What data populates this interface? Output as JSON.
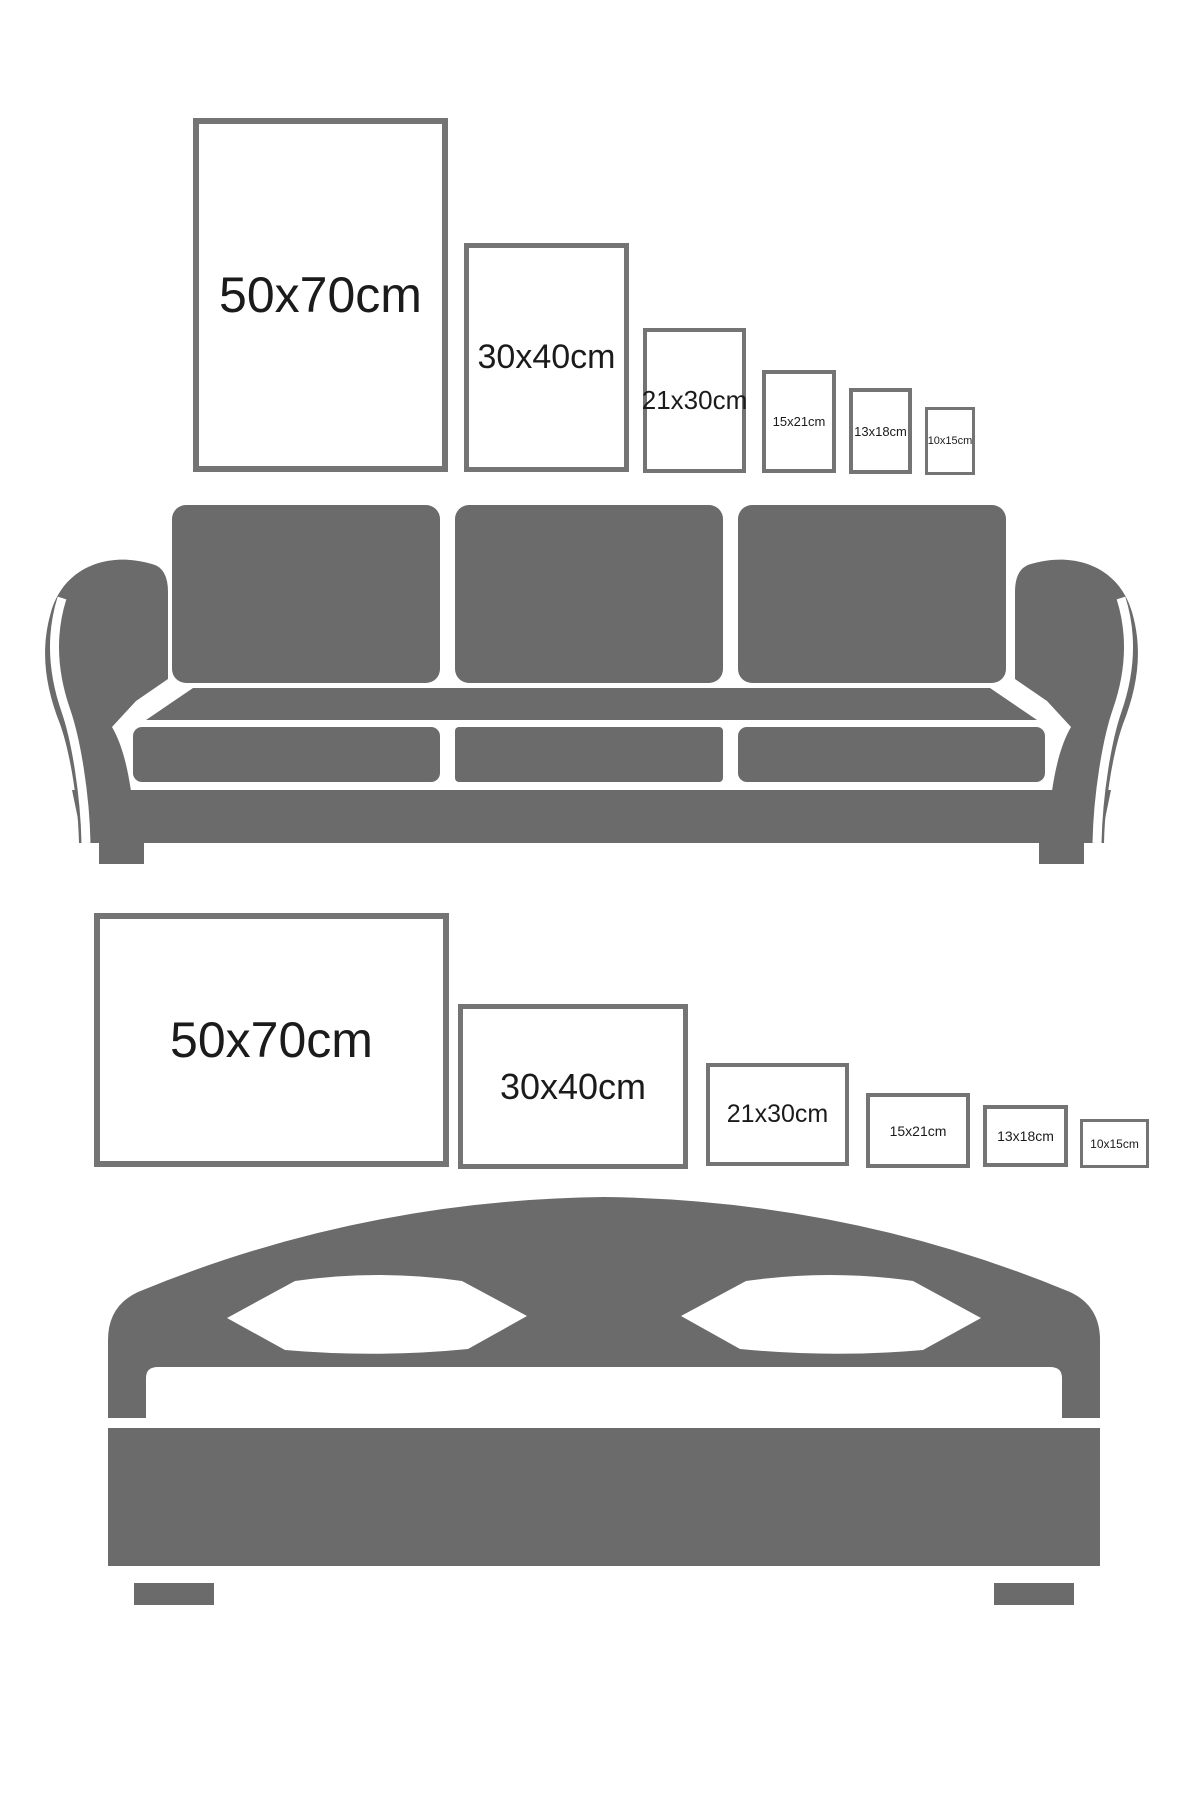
{
  "page": {
    "width": 1200,
    "height": 1800,
    "background": "#ffffff"
  },
  "colors": {
    "furniture_gray": "#6b6b6b",
    "frame_border_gray": "#747474",
    "label_color": "#1b1b1b",
    "frame_fill": "#ffffff"
  },
  "portrait_section": {
    "furniture": "sofa",
    "orientation": "portrait",
    "frames": [
      {
        "label": "50x70cm",
        "x": 193,
        "y": 118,
        "w": 255,
        "h": 354,
        "border_px": 6,
        "font_px": 50
      },
      {
        "label": "30x40cm",
        "x": 464,
        "y": 243,
        "w": 165,
        "h": 229,
        "border_px": 5,
        "font_px": 34
      },
      {
        "label": "21x30cm",
        "x": 643,
        "y": 328,
        "w": 103,
        "h": 145,
        "border_px": 4,
        "font_px": 26
      },
      {
        "label": "15x21cm",
        "x": 762,
        "y": 370,
        "w": 74,
        "h": 103,
        "border_px": 4,
        "font_px": 13
      },
      {
        "label": "13x18cm",
        "x": 849,
        "y": 388,
        "w": 63,
        "h": 86,
        "border_px": 4,
        "font_px": 13
      },
      {
        "label": "10x15cm",
        "x": 925,
        "y": 407,
        "w": 50,
        "h": 68,
        "border_px": 3,
        "font_px": 11
      }
    ]
  },
  "landscape_section": {
    "furniture": "bed",
    "orientation": "landscape",
    "frames": [
      {
        "label": "50x70cm",
        "x": 94,
        "y": 913,
        "w": 355,
        "h": 254,
        "border_px": 6,
        "font_px": 50
      },
      {
        "label": "30x40cm",
        "x": 458,
        "y": 1004,
        "w": 230,
        "h": 165,
        "border_px": 5,
        "font_px": 36
      },
      {
        "label": "21x30cm",
        "x": 706,
        "y": 1063,
        "w": 143,
        "h": 103,
        "border_px": 4,
        "font_px": 25
      },
      {
        "label": "15x21cm",
        "x": 866,
        "y": 1093,
        "w": 104,
        "h": 75,
        "border_px": 4,
        "font_px": 14
      },
      {
        "label": "13x18cm",
        "x": 983,
        "y": 1105,
        "w": 85,
        "h": 62,
        "border_px": 4,
        "font_px": 14
      },
      {
        "label": "10x15cm",
        "x": 1080,
        "y": 1119,
        "w": 69,
        "h": 49,
        "border_px": 3,
        "font_px": 12
      }
    ]
  }
}
